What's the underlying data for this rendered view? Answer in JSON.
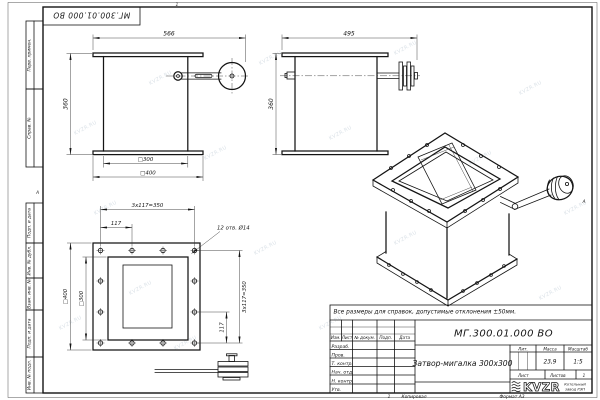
{
  "watermark": "KVZR.RU",
  "sheet": {
    "doc_number_top": "МГ.300.01.000 ВО",
    "zone_left": "А",
    "zone_right": "А",
    "zone_top": "1",
    "margin_labels": {
      "perv": "Перв. примен.",
      "sprav": "Справ. №",
      "podp1": "Подп. и дата",
      "inv_dubl": "Инв. № дубл.",
      "vzam": "Взам. инв. №",
      "podp2": "Подп. и дата",
      "inv_podl": "Инв. № подл."
    },
    "footer": {
      "zone": "1",
      "copied": "Копировал",
      "format": "Формат А3"
    }
  },
  "note": "Все размеры для справок, допустимые отклонения ±50мм.",
  "front_view": {
    "dim_width": "566",
    "dim_height": "360",
    "dim_inner": "□300",
    "dim_outer": "□400"
  },
  "side_view": {
    "dim_width": "495",
    "dim_height": "360"
  },
  "plan_view": {
    "dim_pitch_top": "3х117=350",
    "dim_step_top": "117",
    "dim_holes": "12 отв. Ø14",
    "dim_pitch_right": "3х117=350",
    "dim_step_right": "117",
    "dim_outer": "□400",
    "dim_inner": "□300"
  },
  "title_block": {
    "doc_number": "МГ.300.01.000 ВО",
    "title": "Затвор-мигалка 300х300",
    "columns": {
      "izm": "Изм.",
      "list": "Лист",
      "doc": "№ докум.",
      "podp": "Подп.",
      "date": "Дата"
    },
    "rows": {
      "razrab": "Разраб.",
      "prov": "Пров.",
      "tkontr": "Т. контр.",
      "nachotd": "Нач. отд.",
      "nkontr": "Н. контр.",
      "utv": "Утв."
    },
    "lit": "Лит.",
    "mass": "Масса",
    "scale": "Масштаб",
    "mass_value": "23,9",
    "scale_value": "1:5",
    "sheet": "Лист",
    "sheets": "Листов",
    "sheets_value": "1",
    "logo": "KVZR",
    "company_line1": "Котельный",
    "company_line2": "завод РЭП"
  }
}
